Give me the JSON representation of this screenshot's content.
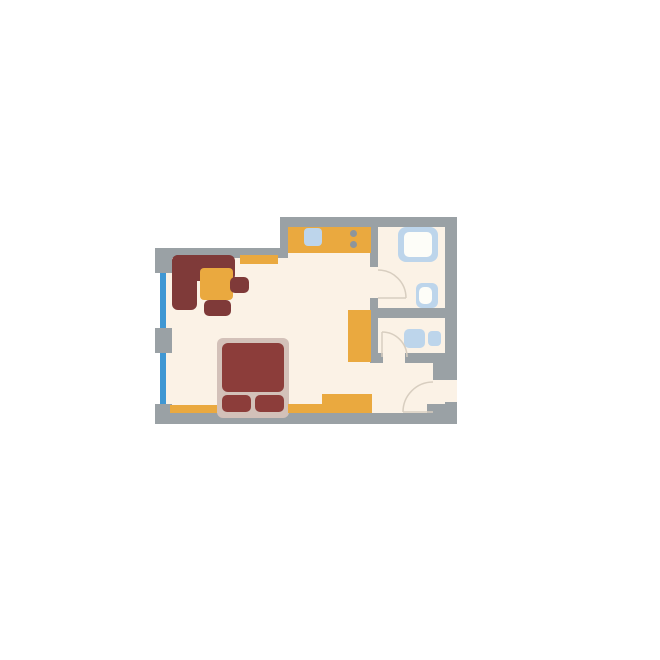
{
  "diagram_type": "apartment-floor-plan",
  "canvas": {
    "width": 660,
    "height": 660,
    "background": "#ffffff"
  },
  "colors": {
    "wall": "#9aa1a5",
    "floor": "#fbf2e6",
    "window": "#3f97d3",
    "furniture_orange": "#eaa93f",
    "furniture_maroon": "#7f3a39",
    "bed_maroon": "#8c3d3a",
    "bed_frame": "#d3c1b9",
    "fixture_blue": "#bdd5eb",
    "fixture_inner": "#fdfdf8",
    "burner_gray": "#8d959b",
    "door_line": "#d8cec0"
  },
  "layers": {
    "floor": [
      {
        "name": "floor-living-room",
        "x": 161,
        "y": 250,
        "w": 127,
        "h": 170,
        "color": "floor"
      },
      {
        "name": "floor-kitchen-bath",
        "x": 280,
        "y": 222,
        "w": 171,
        "h": 198,
        "color": "floor"
      },
      {
        "name": "floor-entry-doorway",
        "x": 443,
        "y": 378,
        "w": 14,
        "h": 32,
        "color": "floor"
      }
    ],
    "windows": [
      {
        "name": "window-upper",
        "x": 160,
        "y": 273,
        "w": 6,
        "h": 55,
        "color": "window"
      },
      {
        "name": "window-lower",
        "x": 160,
        "y": 353,
        "w": 6,
        "h": 52,
        "color": "window"
      }
    ],
    "walls": [
      {
        "name": "wall-top-left",
        "x": 155,
        "y": 248,
        "w": 133,
        "h": 10,
        "color": "wall"
      },
      {
        "name": "wall-step",
        "x": 280,
        "y": 217,
        "w": 8,
        "h": 41,
        "color": "wall"
      },
      {
        "name": "wall-top-right",
        "x": 280,
        "y": 217,
        "w": 177,
        "h": 10,
        "color": "wall"
      },
      {
        "name": "wall-right",
        "x": 445,
        "y": 217,
        "w": 12,
        "h": 161,
        "color": "wall"
      },
      {
        "name": "wall-entry-jamb",
        "x": 433,
        "y": 353,
        "w": 24,
        "h": 27,
        "color": "wall"
      },
      {
        "name": "wall-right-below-door",
        "x": 445,
        "y": 402,
        "w": 12,
        "h": 22,
        "color": "wall"
      },
      {
        "name": "wall-corner-bottom-right",
        "x": 427,
        "y": 404,
        "w": 30,
        "h": 10,
        "color": "wall"
      },
      {
        "name": "wall-bottom",
        "x": 155,
        "y": 413,
        "w": 302,
        "h": 11,
        "color": "wall"
      },
      {
        "name": "wall-left-pier-top",
        "x": 155,
        "y": 248,
        "w": 17,
        "h": 25,
        "color": "wall"
      },
      {
        "name": "wall-left-mullion",
        "x": 155,
        "y": 328,
        "w": 17,
        "h": 25,
        "color": "wall"
      },
      {
        "name": "wall-left-pier-bottom",
        "x": 155,
        "y": 404,
        "w": 17,
        "h": 20,
        "color": "wall"
      },
      {
        "name": "wall-bath-vertical-upper",
        "x": 370,
        "y": 227,
        "w": 8,
        "h": 40,
        "color": "wall"
      },
      {
        "name": "wall-bath-vertical-lower",
        "x": 370,
        "y": 298,
        "w": 8,
        "h": 65,
        "color": "wall"
      },
      {
        "name": "wall-bath2-cap",
        "x": 370,
        "y": 353,
        "w": 13,
        "h": 10,
        "color": "wall"
      },
      {
        "name": "wall-bath-divider",
        "x": 370,
        "y": 308,
        "w": 76,
        "h": 10,
        "color": "wall"
      },
      {
        "name": "wall-bath2-bottom",
        "x": 405,
        "y": 353,
        "w": 41,
        "h": 10,
        "color": "wall"
      }
    ],
    "furniture": [
      {
        "name": "sofa-back",
        "x": 172,
        "y": 255,
        "w": 63,
        "h": 26,
        "r": 6,
        "color": "furniture_maroon"
      },
      {
        "name": "sofa-side",
        "x": 172,
        "y": 255,
        "w": 25,
        "h": 55,
        "r": 6,
        "color": "furniture_maroon"
      },
      {
        "name": "coffee-table",
        "x": 200,
        "y": 268,
        "w": 33,
        "h": 32,
        "r": 4,
        "color": "furniture_orange"
      },
      {
        "name": "armchair-east",
        "x": 230,
        "y": 277,
        "w": 19,
        "h": 16,
        "r": 5,
        "color": "furniture_maroon"
      },
      {
        "name": "armchair-south",
        "x": 204,
        "y": 300,
        "w": 27,
        "h": 16,
        "r": 5,
        "color": "furniture_maroon"
      },
      {
        "name": "wall-shelf",
        "x": 240,
        "y": 255,
        "w": 38,
        "h": 9,
        "r": 0,
        "color": "furniture_orange"
      },
      {
        "name": "kitchen-counter",
        "x": 288,
        "y": 227,
        "w": 83,
        "h": 26,
        "r": 0,
        "color": "furniture_orange"
      },
      {
        "name": "kitchen-sink",
        "x": 304,
        "y": 228,
        "w": 18,
        "h": 18,
        "r": 4,
        "color": "fixture_blue"
      },
      {
        "name": "wardrobe",
        "x": 348,
        "y": 310,
        "w": 23,
        "h": 52,
        "r": 0,
        "color": "furniture_orange"
      },
      {
        "name": "bed-frame",
        "x": 217,
        "y": 338,
        "w": 72,
        "h": 80,
        "r": 6,
        "color": "bed_frame"
      },
      {
        "name": "bed-mattress",
        "x": 222,
        "y": 343,
        "w": 62,
        "h": 49,
        "r": 6,
        "color": "bed_maroon"
      },
      {
        "name": "pillow-left",
        "x": 222,
        "y": 395,
        "w": 29,
        "h": 17,
        "r": 5,
        "color": "bed_maroon"
      },
      {
        "name": "pillow-right",
        "x": 255,
        "y": 395,
        "w": 29,
        "h": 17,
        "r": 5,
        "color": "bed_maroon"
      },
      {
        "name": "bench-left",
        "x": 170,
        "y": 405,
        "w": 47,
        "h": 8,
        "r": 0,
        "color": "furniture_orange"
      },
      {
        "name": "dresser-low",
        "x": 288,
        "y": 404,
        "w": 34,
        "h": 9,
        "r": 0,
        "color": "furniture_orange"
      },
      {
        "name": "dresser-high",
        "x": 322,
        "y": 394,
        "w": 50,
        "h": 19,
        "r": 0,
        "color": "furniture_orange"
      }
    ],
    "fixtures": [
      {
        "name": "shower-outer",
        "x": 398,
        "y": 227,
        "w": 40,
        "h": 35,
        "r": 8,
        "color": "fixture_blue"
      },
      {
        "name": "shower-inner",
        "x": 404,
        "y": 232,
        "w": 28,
        "h": 25,
        "r": 5,
        "color": "fixture_inner"
      },
      {
        "name": "toilet-outer",
        "x": 416,
        "y": 283,
        "w": 22,
        "h": 25,
        "r": 6,
        "color": "fixture_blue"
      },
      {
        "name": "toilet-bowl",
        "x": 419,
        "y": 287,
        "w": 13,
        "h": 17,
        "r": 5,
        "color": "fixture_inner"
      },
      {
        "name": "basin-left",
        "x": 404,
        "y": 329,
        "w": 21,
        "h": 19,
        "r": 5,
        "color": "fixture_blue"
      },
      {
        "name": "basin-right",
        "x": 428,
        "y": 331,
        "w": 13,
        "h": 15,
        "r": 4,
        "color": "fixture_blue"
      }
    ]
  },
  "circles": [
    {
      "name": "stove-burner-1",
      "cx": 353,
      "cy": 233,
      "r": 3.5,
      "color": "burner_gray"
    },
    {
      "name": "stove-burner-2",
      "cx": 353,
      "cy": 244,
      "r": 3.5,
      "color": "burner_gray"
    }
  ],
  "doors": [
    {
      "name": "bathroom1-door",
      "panel": "M378 298 L406 298",
      "arc": "M378 270 A28 28 0 0 1 406 298"
    },
    {
      "name": "bathroom2-door",
      "panel": "M382 332 L382 357",
      "arc": "M382 332 A25 25 0 0 1 407 357"
    },
    {
      "name": "entrance-door",
      "panel": "M403 412 L433 412",
      "arc": "M403 412 A30 30 0 0 1 433 382"
    }
  ]
}
